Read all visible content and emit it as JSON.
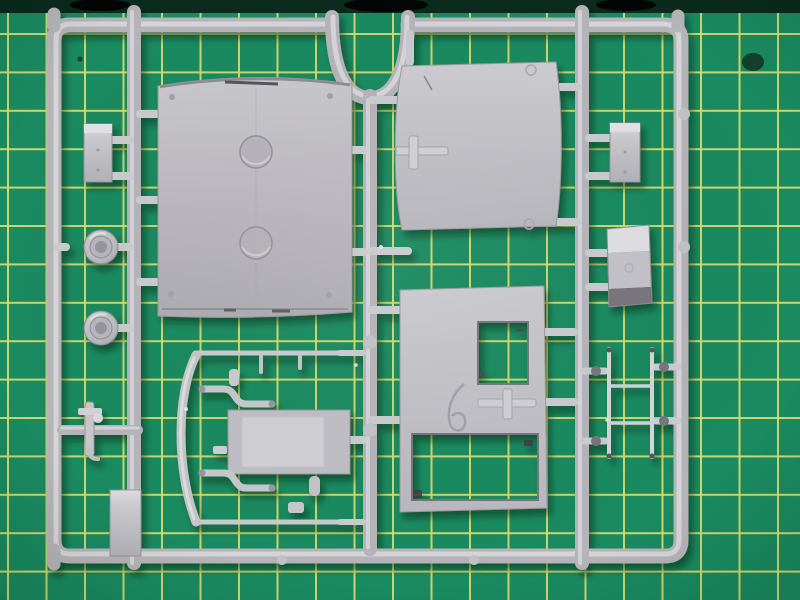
{
  "scene": {
    "description": "Photograph of a light-grey injection-moulded model kit sprue (parts tree) lying on a green self-healing cutting mat with yellow grid lines",
    "type": "photograph",
    "subject": "plastic model kit sprue on cutting mat"
  },
  "colors": {
    "mat_green": "#1a8a60",
    "mat_green_deep": "#14734f",
    "mat_grid_yellow": "#d9dd6a",
    "mat_edge_dark": "#0a2b1d",
    "plastic_highlight": "#d8d8dc",
    "plastic_base": "#b4b4b9",
    "plastic_shadow": "#8a888e",
    "dark_face": "#78757d"
  },
  "mat": {
    "grid_spacing_px": 38.5,
    "grid_line_px": 2
  },
  "parts": [
    {
      "name": "sprue-outer-frame",
      "desc": "rectangular runner frame with rounded corners"
    },
    {
      "name": "top-u-bend-runner",
      "desc": "semicircular dip in the top runner feeding the centre runner"
    },
    {
      "name": "large-roof-panel",
      "desc": "big rectangular panel with two circular recesses"
    },
    {
      "name": "cab-side-panel",
      "desc": "curved-edge panel with raised cross mark"
    },
    {
      "name": "wall-panel-with-window",
      "desc": "panel with square window cutout and large lower opening"
    },
    {
      "name": "door-panel",
      "desc": "small rectangular panel with recessed centre"
    },
    {
      "name": "small-box-left",
      "desc": "small rectangular block part"
    },
    {
      "name": "small-box-right",
      "desc": "small rectangular block part"
    },
    {
      "name": "angled-hopper-box",
      "desc": "angled box part with dark lower face"
    },
    {
      "name": "wheel-upper",
      "desc": "round hub/wheel part"
    },
    {
      "name": "wheel-lower",
      "desc": "round hub/wheel part"
    },
    {
      "name": "ladder-part",
      "desc": "two thin rails with rungs"
    },
    {
      "name": "handrail-rod-top",
      "desc": "thin straight rod"
    },
    {
      "name": "handrail-rod-bottom",
      "desc": "thin straight rod"
    },
    {
      "name": "exhaust-pipe-upper",
      "desc": "S-shaped thin pipe"
    },
    {
      "name": "exhaust-pipe-lower",
      "desc": "S-shaped thin pipe"
    },
    {
      "name": "curved-fender-blade",
      "desc": "long curved strip part"
    },
    {
      "name": "tow-hook-bracket",
      "desc": "small bracket on cross runner"
    },
    {
      "name": "mounting-tab",
      "desc": "flat rectangular tab part"
    }
  ]
}
